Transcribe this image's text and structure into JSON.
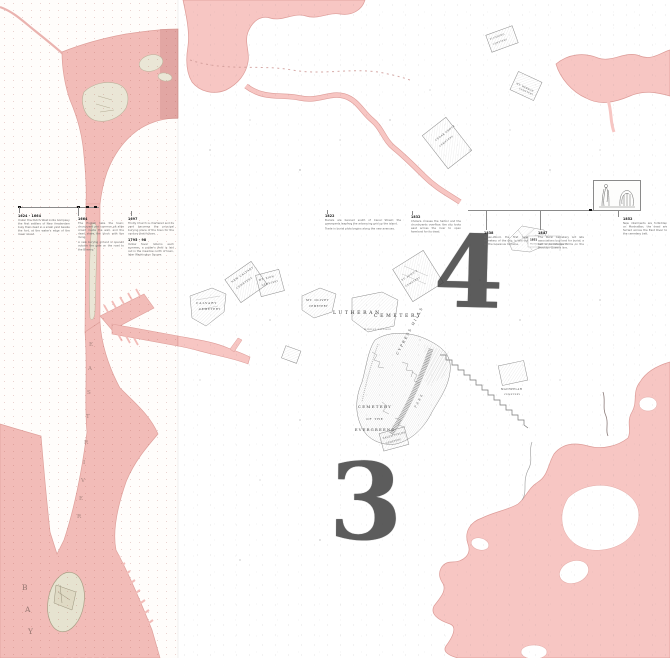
{
  "colors": {
    "strip_water": "#f2bcb8",
    "sheet_water": "#f7c6c3",
    "water_edge": "#dd9c98",
    "island_fill": "#eae6d6",
    "numeral_ink": "#3d3d3d"
  },
  "map": {
    "numerals": {
      "three": "3",
      "four": "4"
    },
    "water_labels": {
      "bay": [
        "B",
        "A",
        "Y"
      ],
      "east_river": [
        "E",
        "A",
        "S",
        "T",
        "R",
        "I",
        "V",
        "E",
        "R"
      ]
    },
    "cemetery_labels": {
      "calvary": [
        "CALVARY",
        "CEMETERY"
      ],
      "new_calvary": [
        "NEW CALVARY",
        "CEMETERY"
      ],
      "mt_zion": [
        "MT. ZION",
        "CEMETERY"
      ],
      "mt_olivet": [
        "MT. OLIVET",
        "CEMETERY"
      ],
      "lutheran": [
        "LUTHERAN",
        "CEMETERY",
        "MIDDLE VILLAGE"
      ],
      "st_johns": [
        "ST. JOHN'S",
        "CEMETERY"
      ],
      "cypress_hills": [
        "CYPRESS HILLS"
      ],
      "evergreens": [
        "CEMETERY",
        "OF THE",
        "EVERGREENS"
      ],
      "park": [
        "PARK"
      ],
      "cedar_grove": [
        "CEDAR GROVE",
        "CEMETERY"
      ],
      "flushing": [
        "FLUSHING",
        "CEMETERY"
      ],
      "mt_hebron": [
        "MT. HEBRON",
        "CEMETERY"
      ],
      "machpelah": [
        "MACHPELAH",
        "CEMETERY"
      ],
      "salem_fields": [
        "SALEM FIELDS",
        "CEMETERY"
      ]
    }
  },
  "timeline": {
    "events": [
      {
        "date": "1624 - 1664",
        "text": "Under the Dutch West India Company the first settlers of New Amsterdam bury their dead in a small yard beside the fort, at the water's edge of the lower island."
      },
      {
        "date": "1664",
        "text": "The English take the town; churchyard and common pit alike crowd inside the wall, and the dead share the block with the living.",
        "text2": "A new burying ground is opened outside the gate on the road to the Bowery."
      },
      {
        "date": "1697",
        "text": "Trinity Church is chartered and its yard becomes the principal burying place of the town for the century that follows."
      },
      {
        "date": "1795 - 98",
        "text": "Yellow fever returns each summer; a potter's field is laid out in the meadow north of town, later Washington Square."
      },
      {
        "date": "1822",
        "text": "Burials are banned south of Canal Street; the graveyards leapfrog the advancing grid up the island.",
        "text2": "Trade in burial plots begins along the new avenues."
      },
      {
        "date": "1832",
        "text": "Cholera crosses the harbor and the churchyards overflow; the city looks east across the river to open farmland for its dead."
      },
      {
        "date": "1838",
        "text": "Green-Wood, the first rural cemetery of the city, is laid out on the Gowanus moraine."
      },
      {
        "date": "1847",
        "text": "The Rural Cemetery Act lets associations buy land for burial; a belt of cemeteries forms on the Brooklyn-Queens line."
      },
      {
        "date": "1852",
        "text": "New interments are forbidden on Manhattan; the dead are ferried across the East River to the cemetery belt."
      }
    ],
    "sketch": {
      "date": "1851",
      "caption": "The Evergreens, plan of the grounds"
    }
  }
}
